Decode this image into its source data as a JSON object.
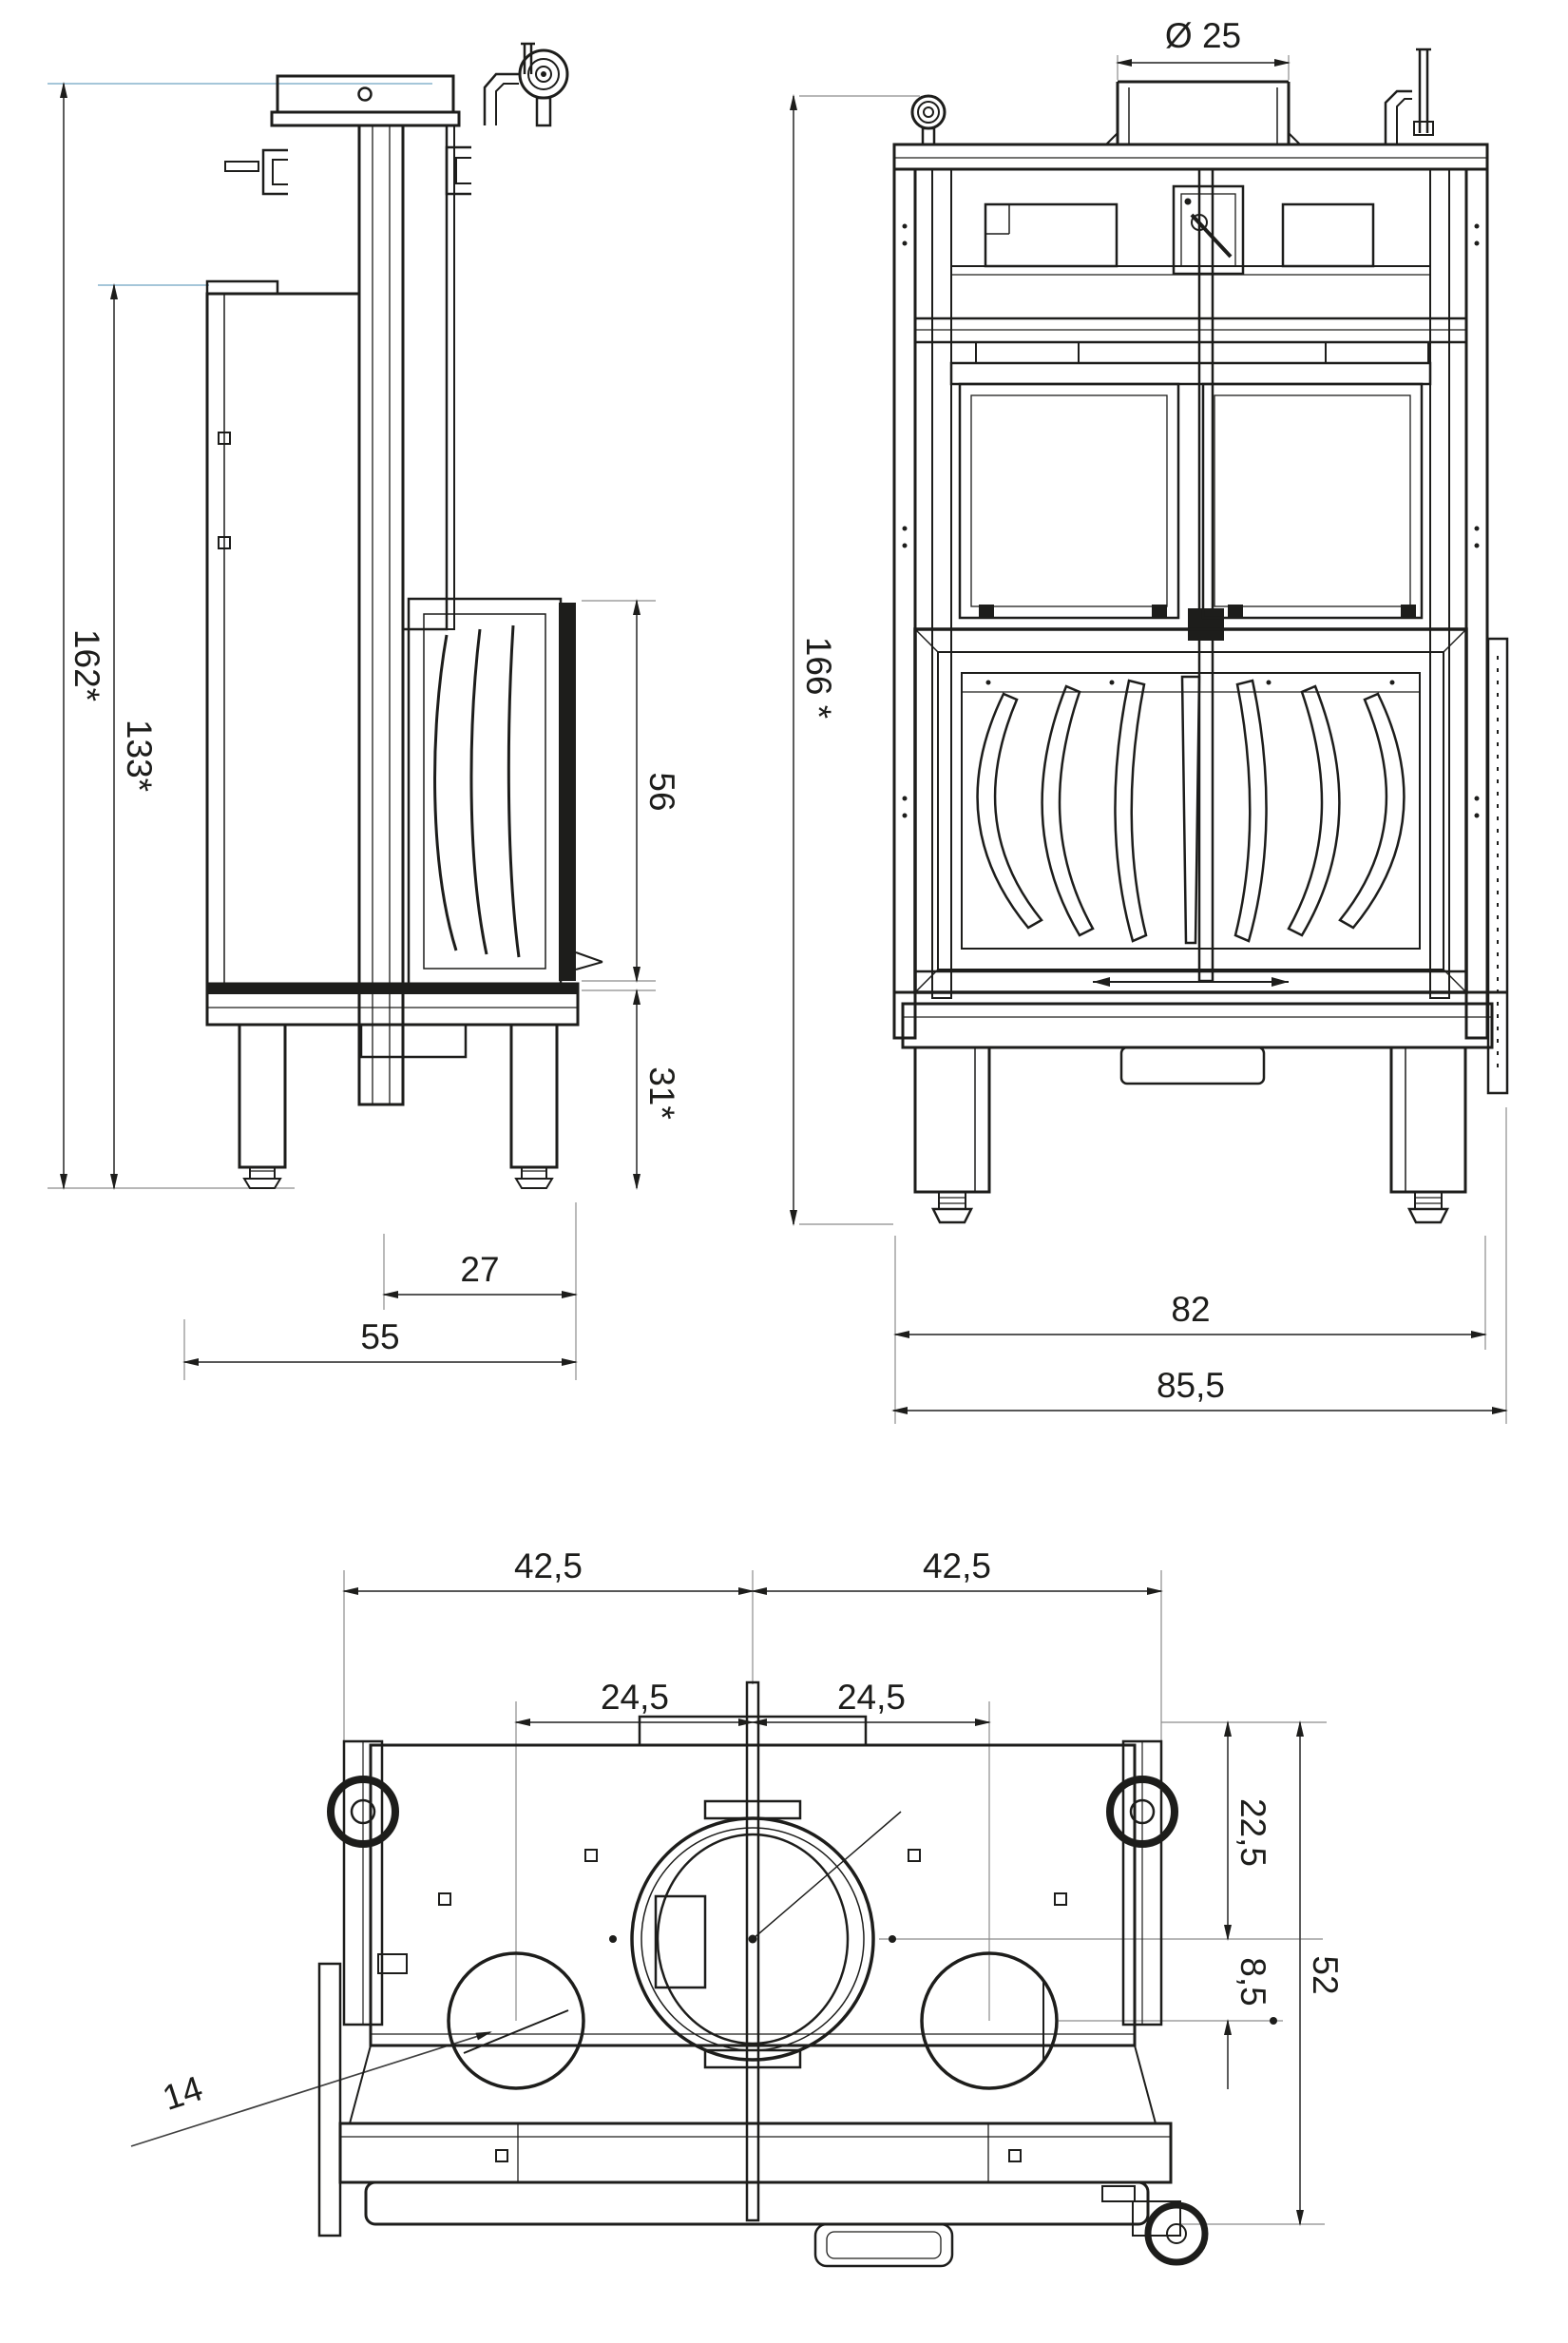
{
  "drawing_title": "Fireplace insert dimensional drawing (side, front and top views)",
  "colors": {
    "line": "#1d1d1b",
    "dimension_line": "#3f3f3f",
    "extension_line": "#8c8c8c",
    "accent_extension_line": "#a5c6d9",
    "background": "#ffffff"
  },
  "side_view": {
    "overall_height": "162*",
    "body_height": "133*",
    "door_height": "56",
    "base_height": "31*",
    "door_depth": "27",
    "overall_depth": "55"
  },
  "front_view": {
    "flue_diameter": "Ø 25",
    "overall_height": "166 *",
    "inner_width": "82",
    "overall_width": "85,5"
  },
  "plan_view": {
    "left_half_width": "42,5",
    "right_half_width": "42,5",
    "left_outlet_offset": "24,5",
    "right_outlet_offset": "24,5",
    "flue_center_depth": "22,5",
    "outlet_center_offset": "8,5",
    "overall_depth": "52",
    "outlet_diameter": "14"
  }
}
